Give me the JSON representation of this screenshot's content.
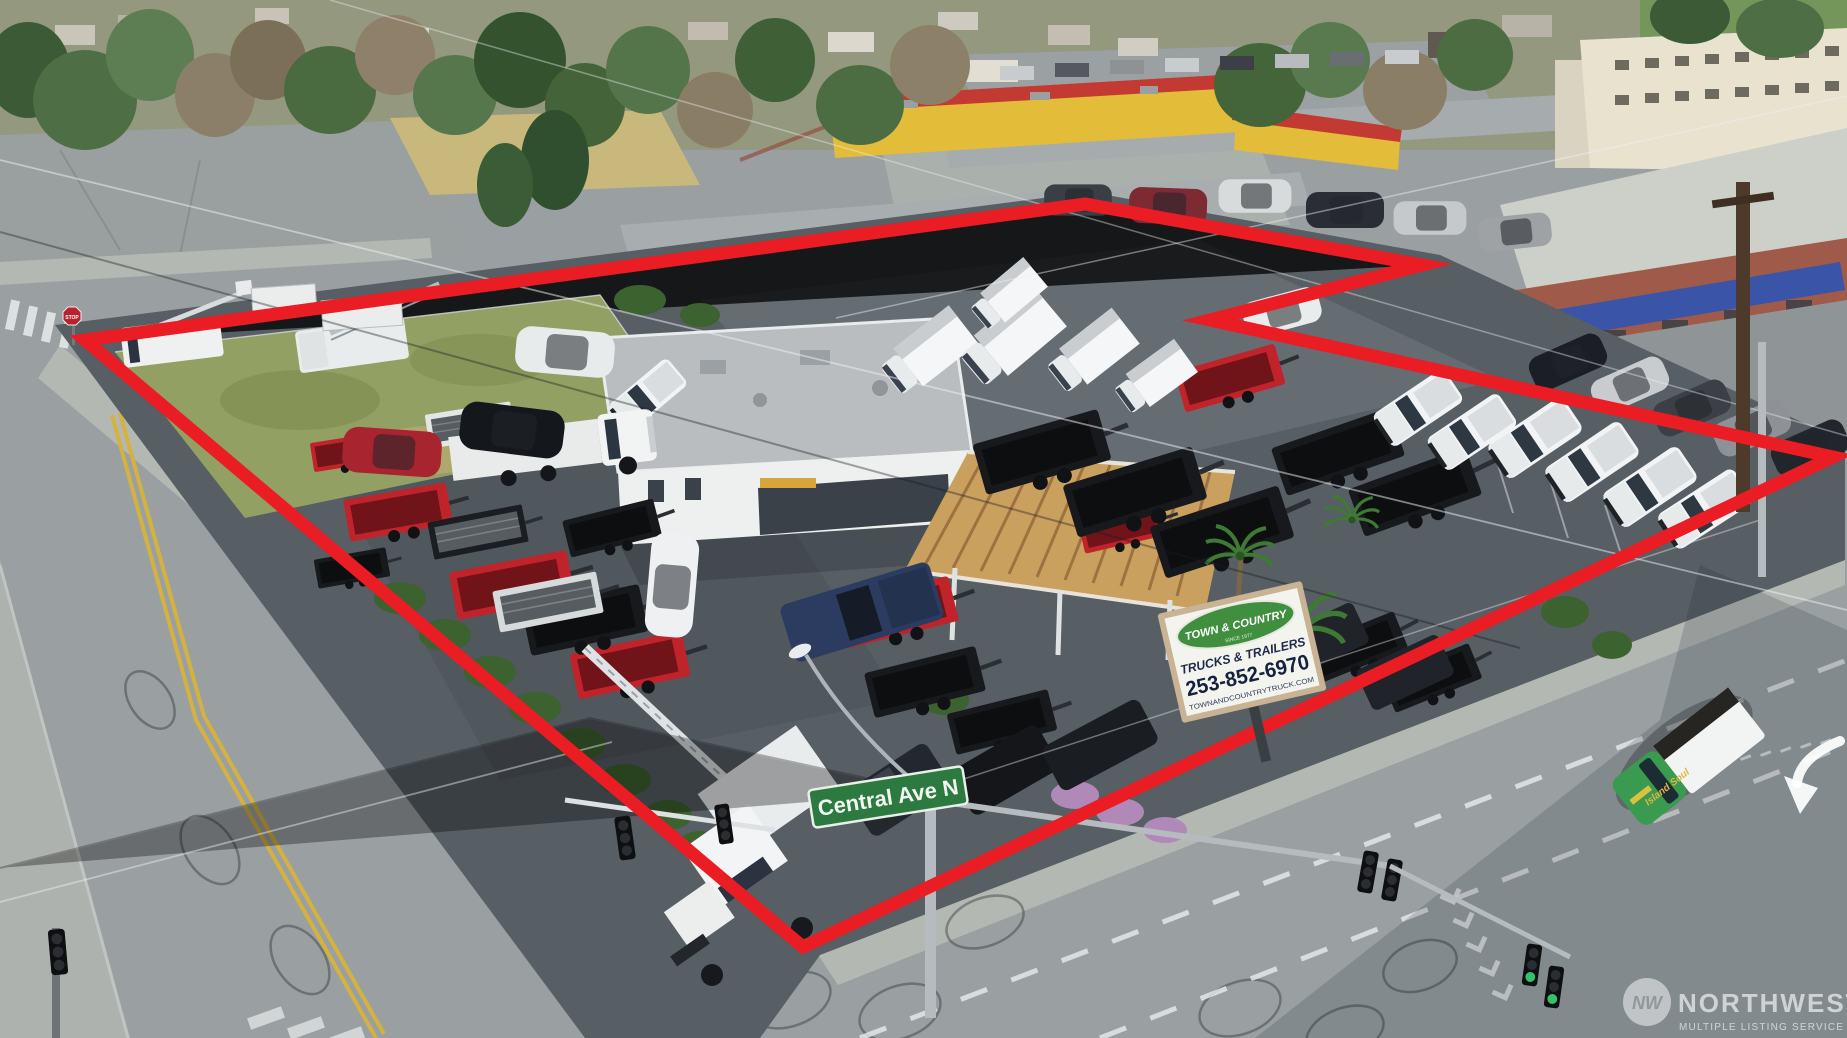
{
  "scene": {
    "type": "aerial-drone-photo",
    "subject": "Corner commercial lot of a truck and trailer dealership outlined in red, at Central Ave N"
  },
  "boundary": {
    "points": "85,340 1085,204 1422,265 1210,320 1833,457 803,947",
    "color": "#ea1c24"
  },
  "street_sign": {
    "label": "Central Ave N",
    "color": "#2d7a41"
  },
  "dealer_sign": {
    "brand": "TOWN & COUNTRY",
    "since": "SINCE 1977",
    "category": "TRUCKS & TRAILERS",
    "phone": "253-852-6970",
    "website": "TOWNANDCOUNTRYTRUCK.COM",
    "oval_color": "#3f8f3f"
  },
  "stop_sign": {
    "label": "STOP"
  },
  "van": {
    "brand": "Island Soul",
    "color": "#3a9a50"
  },
  "watermark": {
    "name": "NORTHWEST",
    "tagline": "MULTIPLE LISTING SERVICE",
    "monogram": "NW"
  }
}
